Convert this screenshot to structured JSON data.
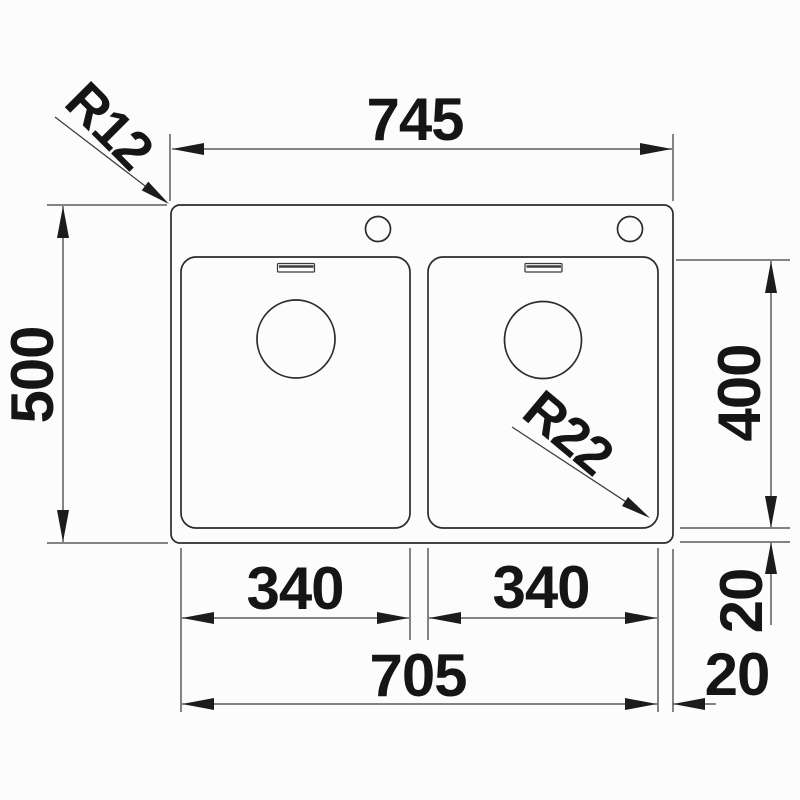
{
  "colors": {
    "background": "#fcfcfc",
    "line": "#2b2b2b",
    "dim_line": "#3c3c3c",
    "text": "#151515"
  },
  "drawing": {
    "dimensions": {
      "overall_width": "745",
      "overall_depth": "500",
      "bowl_depth": "400",
      "left_bowl_width": "340",
      "right_bowl_width": "340",
      "bowls_span": "705",
      "right_rim_offset": "20",
      "bottom_rim_offset": "20"
    },
    "radii": {
      "outer_corner": "R12",
      "bowl_corner": "R22"
    }
  }
}
